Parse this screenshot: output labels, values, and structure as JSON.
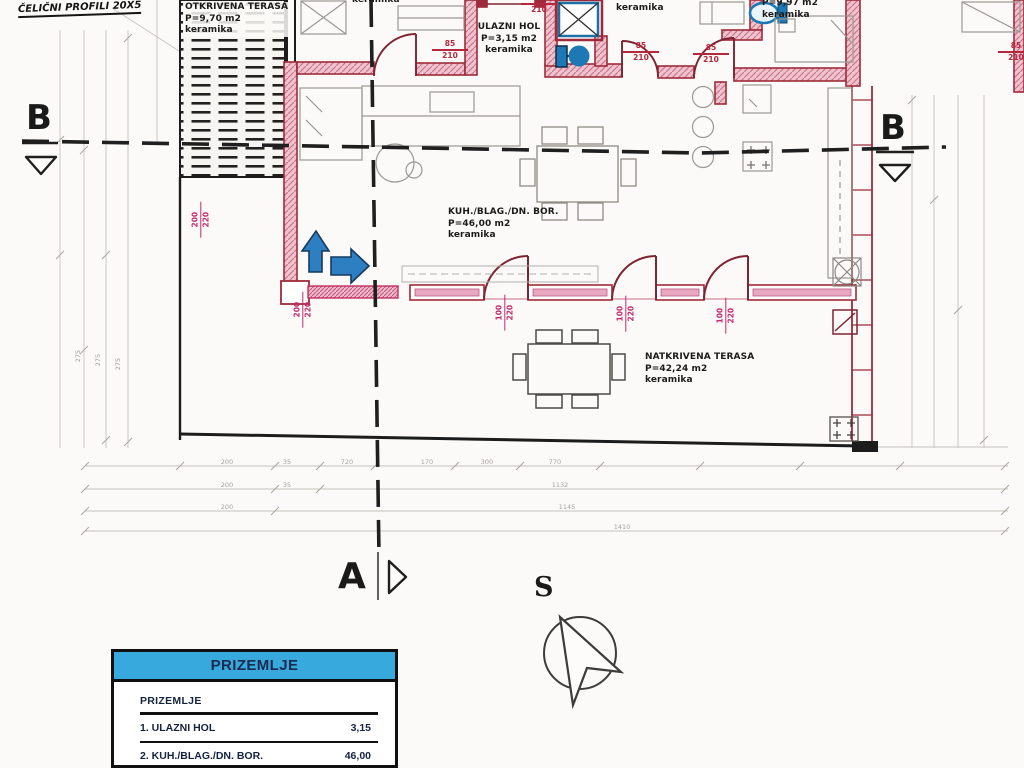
{
  "title_note": "ČELIČNI PROFILI 20X5",
  "rooms": {
    "otkrivena_terasa": {
      "name": "OTKRIVENA TERASA",
      "area": "P=9,70 m2",
      "floor": "keramika"
    },
    "ulazni_hol": {
      "name": "ULAZNI HOL",
      "area": "P=3,15 m2",
      "floor": "keramika"
    },
    "kuh_blag_dn_bor": {
      "name": "KUH./BLAG./DN. BOR.",
      "area": "P=46,00 m2",
      "floor": "keramika"
    },
    "natkrivena_terasa": {
      "name": "NATKRIVENA TERASA",
      "area": "P=42,24 m2",
      "floor": "keramika"
    },
    "top_right_room": {
      "area": "P=9,97 m2",
      "floor": "keramika"
    },
    "top_partial_room": {
      "floor": "keramika"
    },
    "top_middle_room": {
      "floor": "keramika"
    }
  },
  "section_markers": {
    "b_left": "B",
    "b_right": "B",
    "a_bottom": "A",
    "north": "S"
  },
  "door_dims": {
    "w85": "85",
    "w72": "72",
    "w100": "100",
    "w200": "200",
    "h210": "210",
    "h220": "220"
  },
  "dimension_chains": {
    "bottom_row_1": [
      "200",
      "35",
      "720",
      "170",
      "300",
      "770"
    ],
    "bottom_row_2": [
      "200",
      "35",
      "1132"
    ],
    "bottom_row_3": [
      "200",
      "1145"
    ],
    "bottom_row_4": [
      "1410"
    ],
    "left_side": [
      "275",
      "275",
      "275"
    ]
  },
  "legend_table": {
    "header": "PRIZEMLJE",
    "subtitle": "PRIZEMLJE",
    "rows": [
      {
        "label": "1. ULAZNI HOL",
        "value": "3,15"
      },
      {
        "label": "2. KUH./BLAG./DN. BOR.",
        "value": "46,00"
      }
    ]
  },
  "colors": {
    "wall_red": "#9e2b3b",
    "wall_fill": "#f0c4cf",
    "door_arc": "#7e2433",
    "glazing_pink": "#c2306a",
    "fixture_blue": "#1d78b5",
    "arrow_blue": "#2d7fc1",
    "legend_header_blue": "#38a9dd",
    "legend_text_navy": "#15233f",
    "section_line_black": "#1f1f1f",
    "faint_gray": "#b9b5af"
  }
}
